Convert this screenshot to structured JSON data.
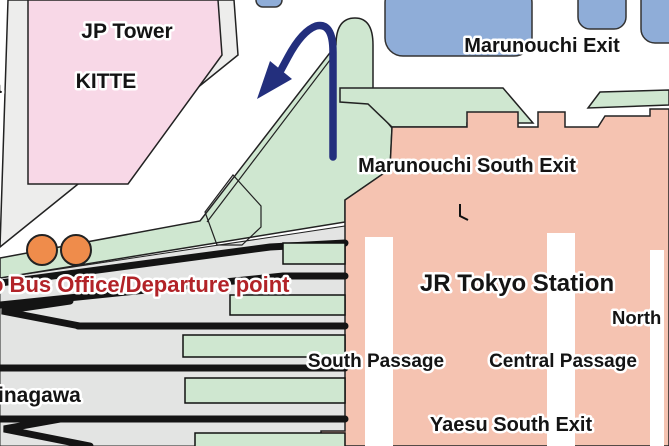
{
  "map": {
    "labels": {
      "jp_tower": "JP Tower",
      "kitte": "KITTE",
      "marunouchi_exit": "Marunouchi Exit",
      "marunouchi_south_exit": "Marunouchi South Exit",
      "jr_tokyo_station": "JR Tokyo Station",
      "north_partial": "North",
      "south_passage": "South Passage",
      "central_passage": "Central Passage",
      "yaesu_south_exit": "Yaesu South Exit",
      "shinagawa_partial": "inagawa",
      "bus_office": "o Bus Office/Departure point",
      "left_edge_fragment": "a"
    },
    "icons": {
      "bus_stop_markers": 2,
      "direction_arrow": "curved arrow pointing down-left from Marunouchi South Exit"
    },
    "colors": {
      "building_pink": "#f8d8e7",
      "sidewalk_gray": "#ededec",
      "concourse_green": "#cfe7d0",
      "plaza_blue": "#8fadd8",
      "station_salmon": "#f5c3b1",
      "yard_gray": "#e3e4e3",
      "bus_stop_orange": "#ef8c4b",
      "arrow_navy": "#232f7d",
      "bus_text_red": "#b22328",
      "track_black": "#141414",
      "label_black": "#141414",
      "outline_dark": "#222222",
      "passage_white": "#ffffff"
    }
  }
}
